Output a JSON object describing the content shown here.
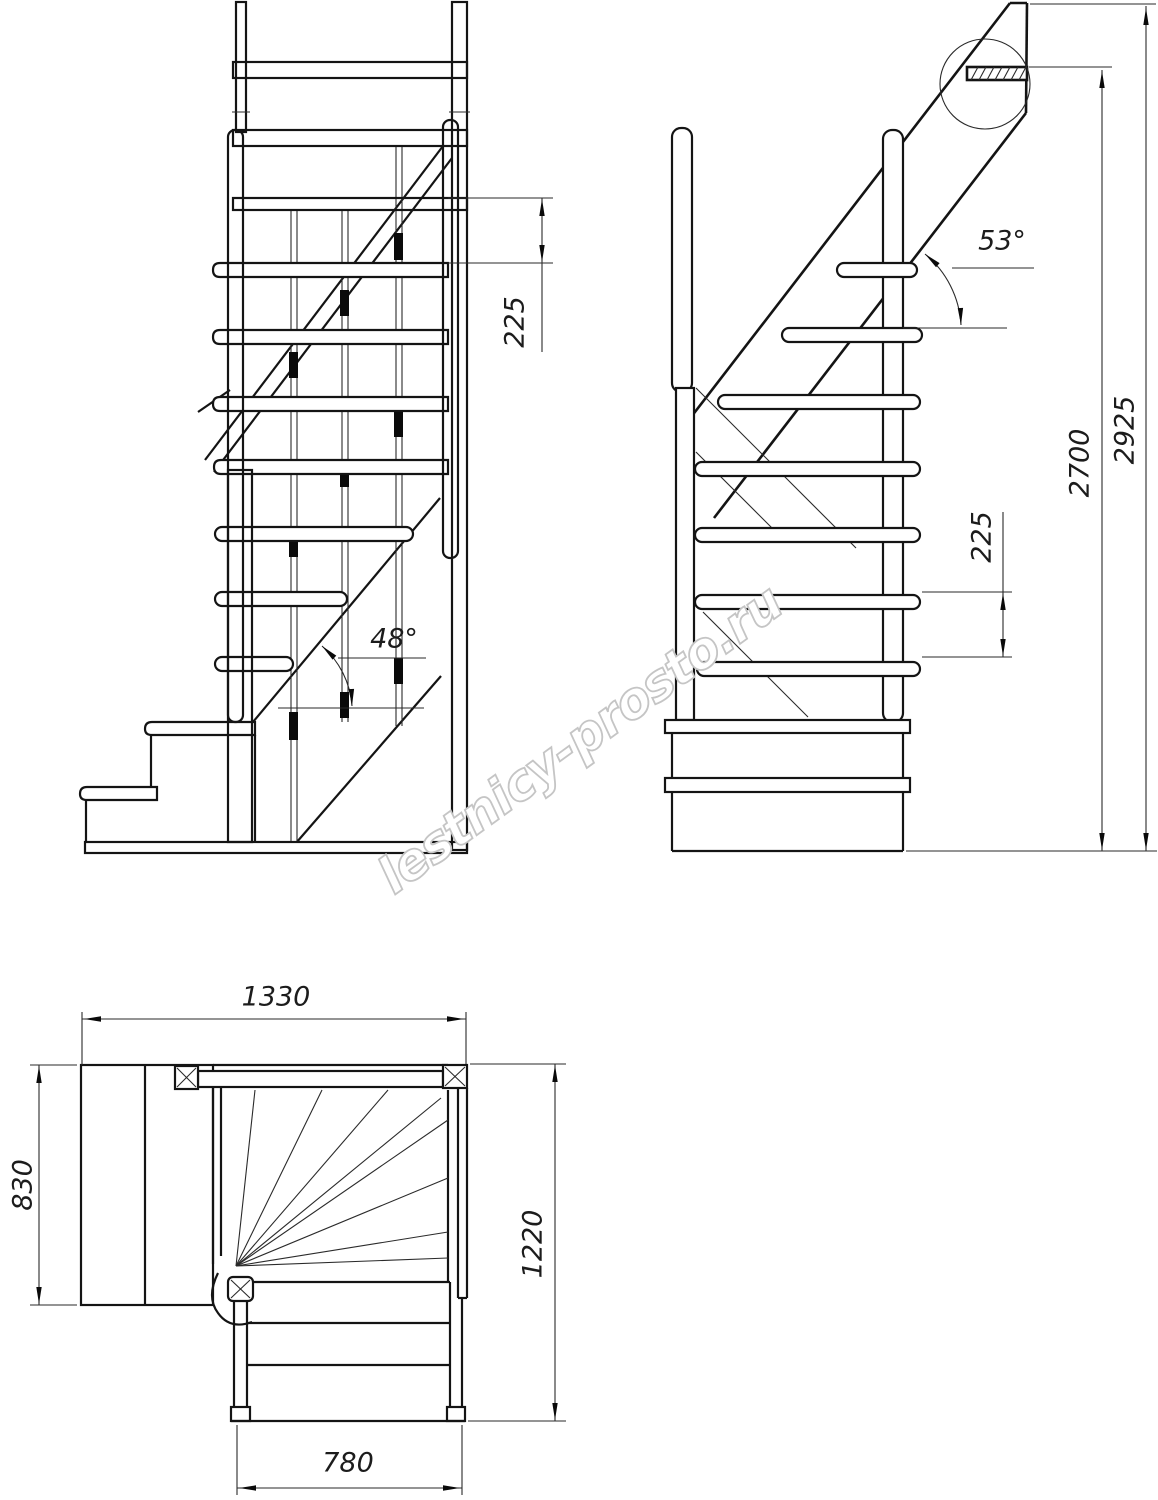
{
  "drawing": {
    "type": "staircase technical drawing",
    "background_color": "#ffffff",
    "line_color": "#141414",
    "watermark": {
      "text": "lestnicy-prosto.ru",
      "color": "#c5c5c5"
    },
    "views": {
      "front": {
        "name": "front elevation",
        "dimensions": {
          "riser_spacing": "225",
          "lower_flight_angle": "48°"
        }
      },
      "side": {
        "name": "side elevation",
        "dimensions": {
          "riser_spacing": "225",
          "upper_flight_angle": "53°",
          "floor_to_floor_height": "2700",
          "total_height": "2925"
        }
      },
      "plan": {
        "name": "plan view",
        "dimensions": {
          "overall_width": "1330",
          "landing_depth": "830",
          "overall_depth": "1220",
          "flight_width": "780"
        }
      }
    }
  }
}
